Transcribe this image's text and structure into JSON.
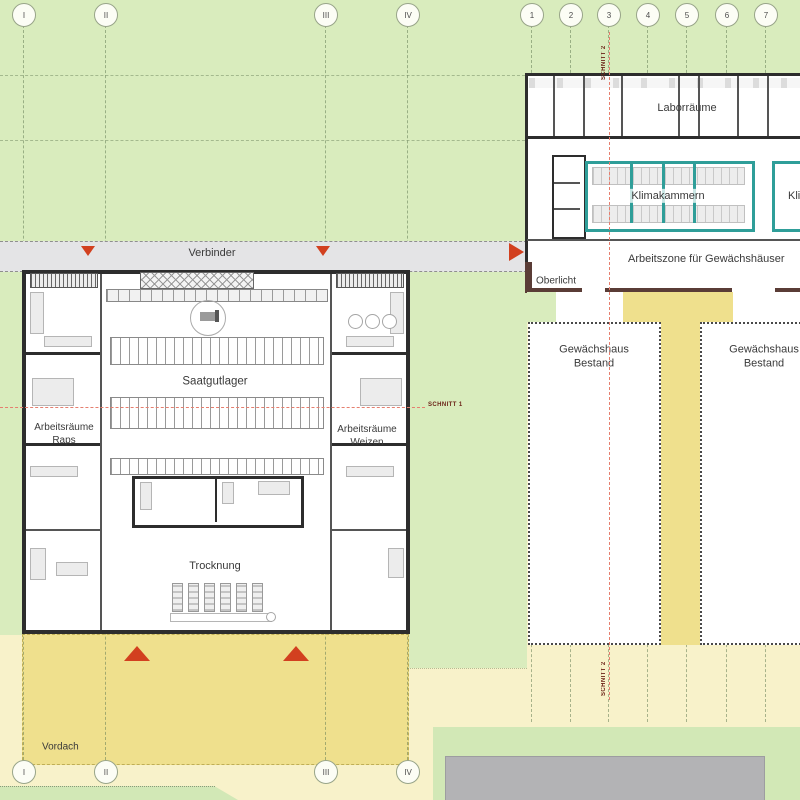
{
  "grid": {
    "top_left": [
      "I",
      "II",
      "III",
      "IV"
    ],
    "top_right": [
      "1",
      "2",
      "3",
      "4",
      "5",
      "6",
      "7"
    ],
    "bottom": [
      "I",
      "II",
      "III",
      "IV"
    ]
  },
  "corridor": {
    "verbinder": "Verbinder",
    "oberlicht": "Oberlicht"
  },
  "left_building": {
    "saatgutlager": "Saatgutlager",
    "raps_line1": "Arbeitsräume",
    "raps_line2": "Raps",
    "weizen_line1": "Arbeitsräume",
    "weizen_line2": "Weizen",
    "trocknung": "Trocknung",
    "vordach": "Vordach"
  },
  "right_building": {
    "laborraeume": "Laborräume",
    "klimakammern_west": "Klimakammern",
    "klimakammern_east": "Klimakammern",
    "arbeitszone": "Arbeitszone für Gewächshäuser",
    "gewaechshaus_west_line1": "Gewächshaus",
    "gewaechshaus_west_line2": "Bestand",
    "gewaechshaus_east_line1": "Gewächshaus",
    "gewaechshaus_east_line2": "Bestand"
  },
  "sections": {
    "schnitt1": "SCHNITT 1",
    "schnitt2_top": "SCHNITT 2",
    "schnitt2_bottom": "SCHNITT 2"
  },
  "colors": {
    "site_green": "#d9ecbd",
    "field_yellow": "#f8f2ca",
    "canopy_yellow": "#efe08d",
    "corridor_gray": "#e4e4e6",
    "paving_gray": "#b3b3b5",
    "climate_teal": "#2f9e99",
    "arrow_red": "#d2401f",
    "section_red": "#e57f6f",
    "wall_dark": "#2d2d2d",
    "wall_maroon": "#5a3c36"
  }
}
